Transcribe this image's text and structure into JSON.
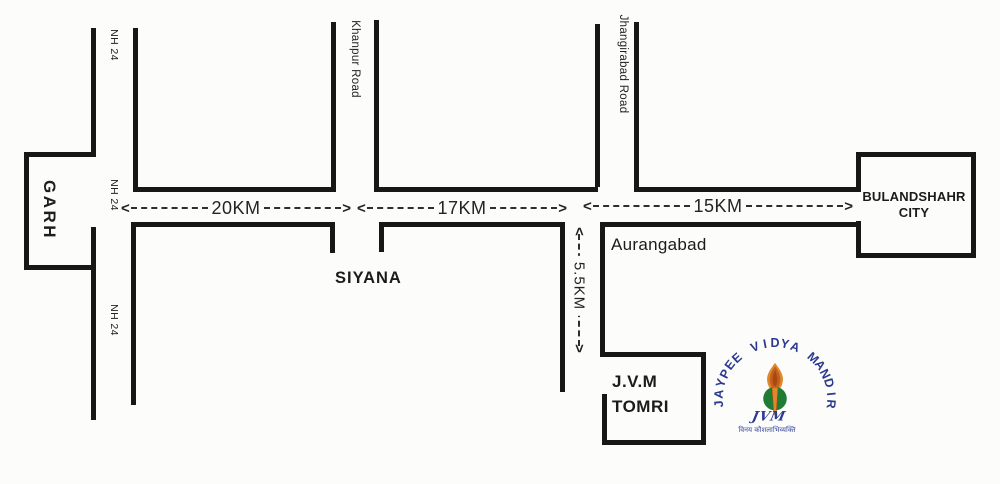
{
  "map": {
    "places": {
      "garh": "GARH",
      "siyana": "SIYANA",
      "aurangabad": "Aurangabad",
      "jvm_tomri_line1": "J.V.M",
      "jvm_tomri_line2": "TOMRI",
      "bulandshahr_line1": "BULANDSHAHR",
      "bulandshahr_line2": "CITY"
    },
    "road_labels": {
      "nh24_top": "NH 24",
      "nh24_mid": "NH 24",
      "nh24_bottom": "NH 24",
      "khanpur": "Khanpur Road",
      "jhangirabad": "Jhangirabad Road"
    },
    "distances": {
      "garh_to_khanpur": "20KM",
      "khanpur_to_jhangirabad": "17KM",
      "jhangirabad_to_bulandshahr": "15KM",
      "highway_to_jvm": "5.5KM"
    }
  },
  "logo": {
    "arc_text": "JAYPEE VIDYA MANDIR",
    "monogram": "JVM",
    "motto": "विनय कौशलाभिव्यक्ति",
    "colors": {
      "navy": "#2b3990",
      "green": "#1e7c35",
      "orange": "#e0862c",
      "orange_mid": "#c2611c",
      "orange_dark": "#a84a10",
      "ink": "#171717"
    }
  }
}
